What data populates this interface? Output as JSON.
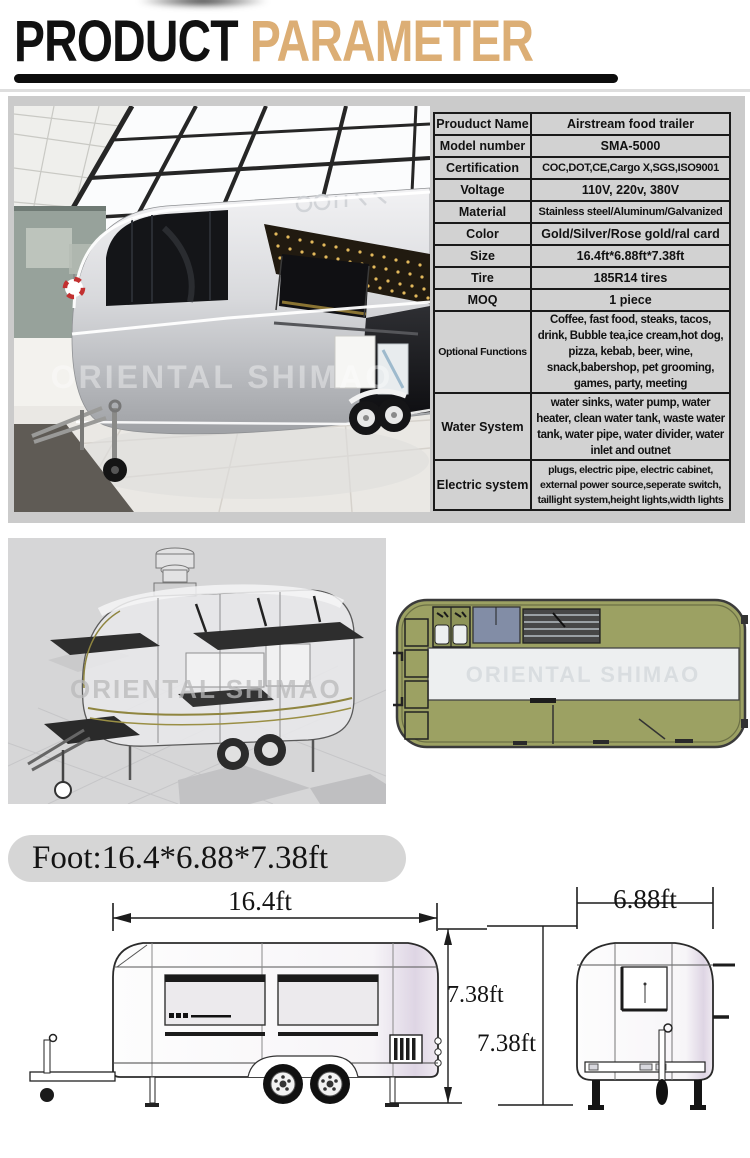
{
  "header": {
    "title_black": "PRODUCT",
    "title_tan": " PARAMETER",
    "accent_color": "#dcae75"
  },
  "spec_table": {
    "rows": [
      {
        "label": "Prouduct Name",
        "value": "Airstream food trailer"
      },
      {
        "label": "Model number",
        "value": "SMA-5000"
      },
      {
        "label": "Certification",
        "value": "COC,DOT,CE,Cargo X,SGS,ISO9001"
      },
      {
        "label": "Voltage",
        "value": "110V, 220v, 380V"
      },
      {
        "label": "Material",
        "value": "Stainless steel/Aluminum/Galvanized"
      },
      {
        "label": "Color",
        "value": "Gold/Silver/Rose gold/ral card"
      },
      {
        "label": "Size",
        "value": "16.4ft*6.88ft*7.38ft"
      },
      {
        "label": "Tire",
        "value": "185R14 tires"
      },
      {
        "label": "MOQ",
        "value": "1 piece"
      },
      {
        "label": "Optional Functions",
        "value": "Coffee, fast food, steaks, tacos, drink, Bubble tea,ice cream,hot dog, pizza, kebab, beer, wine, snack,babershop, pet grooming, games, party, meeting"
      },
      {
        "label": "Water System",
        "value": "water sinks, water pump, water heater, clean water tank, waste water tank, water pipe, water divider, water inlet and outnet"
      },
      {
        "label": "Electric system",
        "value": "plugs, electric pipe, electric cabinet, external power source,seperate switch, taillight system,height lights,width lights"
      }
    ]
  },
  "photo": {
    "watermark": "ORIENTAL SHIMAO"
  },
  "drawings": {
    "render_watermark": "ORIENTAL SHIMAO",
    "plan_watermark": "ORIENTAL SHIMAO",
    "olive_color": "#9ca163"
  },
  "footprint": {
    "label": "Foot:16.4*6.88*7.38ft",
    "length": "16.4ft",
    "height_side": "7.38ft",
    "height_rear": "7.38ft",
    "width": "6.88ft"
  }
}
